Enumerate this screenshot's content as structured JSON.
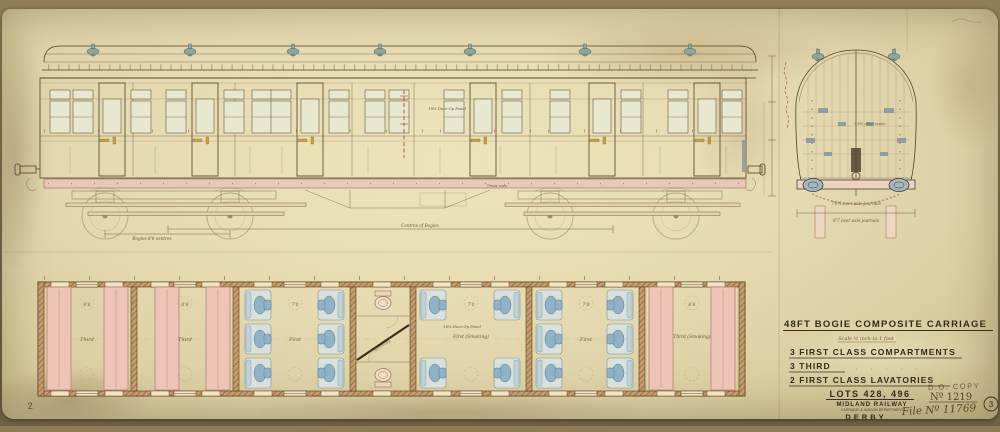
{
  "page": {
    "page_number": "2"
  },
  "palette": {
    "paper": "#e5dab0",
    "ink": "#52412a",
    "first_class_seat": "#8fb2c6",
    "third_class_seat": "#eec3b8",
    "brass": "#c9a23a",
    "red_ink": "#a8452e",
    "stamp_grey": "#8f87a0"
  },
  "title_block": {
    "title": "48FT BOGIE COMPOSITE CARRIAGE",
    "scale_note": "Scale ½ inch to 1 foot",
    "spec_lines": [
      {
        "label": "3 FIRST CLASS COMPARTMENTS"
      },
      {
        "label": "3 THIRD"
      },
      {
        "label": "2 FIRST CLASS LAVATORIES"
      }
    ],
    "lots": "LOTS 428, 496",
    "stamp": "D.O. COPY",
    "drawing_number": "Nº 1219",
    "file_number": "File Nº 11769",
    "railway": "MIDLAND RAILWAY",
    "department": "CARRIAGE & WAGON DEPARTMENT",
    "place": "DERBY",
    "approval_stamp": "3"
  },
  "elevation": {
    "door_note": "18½ Door Op Panel",
    "truss_note": "Truss rods",
    "dim_bogies": "Bogies 8'0 centres",
    "dim_centres": "Centres of Bogies"
  },
  "end_view": {
    "inside_note": "8'0½ clear inside",
    "caption_over_journals": "7'0½ over axle journals",
    "caption_over_stanchions": "8'7 over axle journals"
  },
  "plan": {
    "door_note": "18½ Door Op Panel",
    "lavatory_label": "Lavatory",
    "compartments": [
      {
        "label": "Third",
        "dim": "6'6"
      },
      {
        "label": "Third",
        "dim": "6'6"
      },
      {
        "label": "First",
        "dim": "7'0"
      },
      {
        "label": "First (Smoking)",
        "dim": "7'0"
      },
      {
        "label": "First",
        "dim": "7'0"
      },
      {
        "label": "Third (Smoking)",
        "dim": "6'6"
      }
    ]
  }
}
